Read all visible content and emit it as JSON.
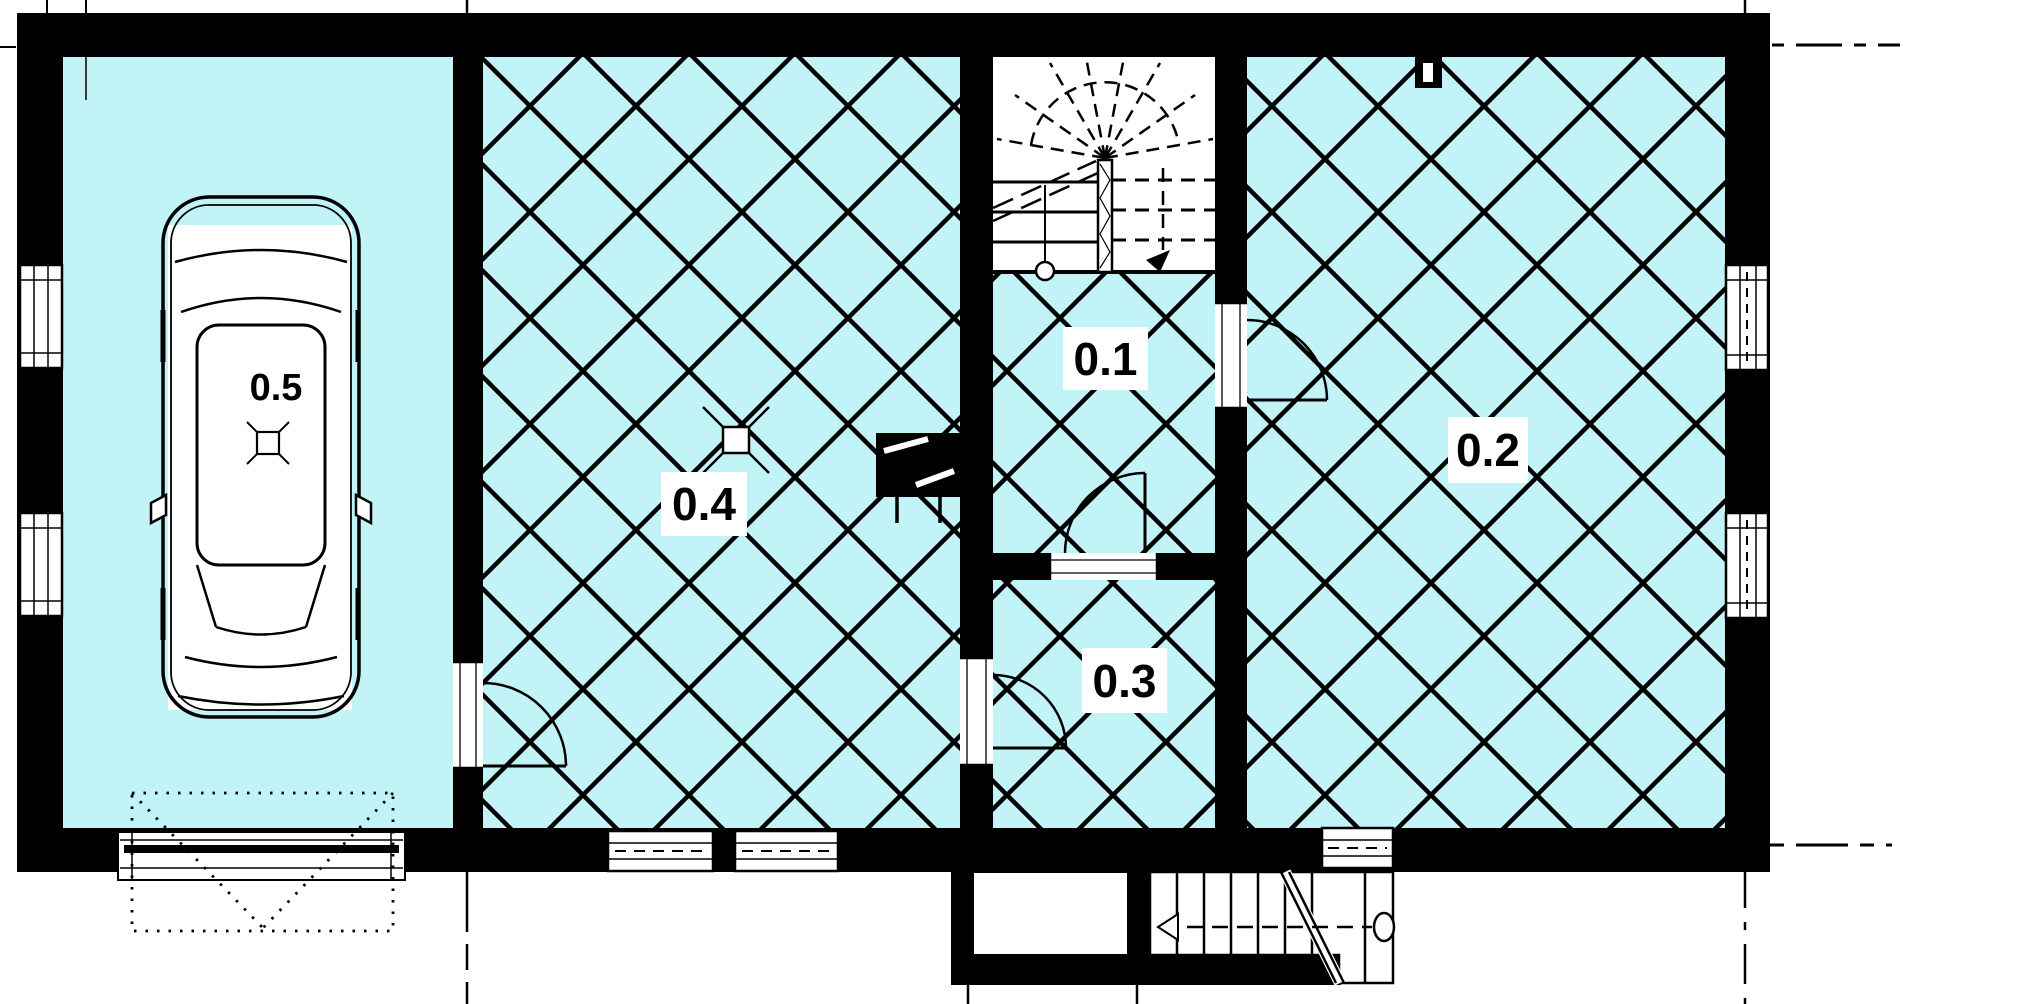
{
  "plan": {
    "kind": "architectural floor plan",
    "rooms": {
      "r01": {
        "label": "0.1"
      },
      "r02": {
        "label": "0.2"
      },
      "r03": {
        "label": "0.3"
      },
      "r04": {
        "label": "0.4"
      },
      "r05": {
        "label": "0.5"
      }
    },
    "colors": {
      "floor_fill": "#c1f3f7",
      "wall": "#000000",
      "line": "#000000",
      "background": "#ffffff"
    },
    "icons": {
      "car": "car-icon",
      "floor_drain": "floor-drain-icon",
      "sunroof": "sunroof-icon",
      "stove": "stove-icon",
      "stair_down_arrow": "stair-down-arrow-icon",
      "exterior_stair_arrow": "exterior-stair-arrow-icon",
      "wall_flue": "wall-flue-icon",
      "newel_post": "newel-post-icon"
    }
  }
}
